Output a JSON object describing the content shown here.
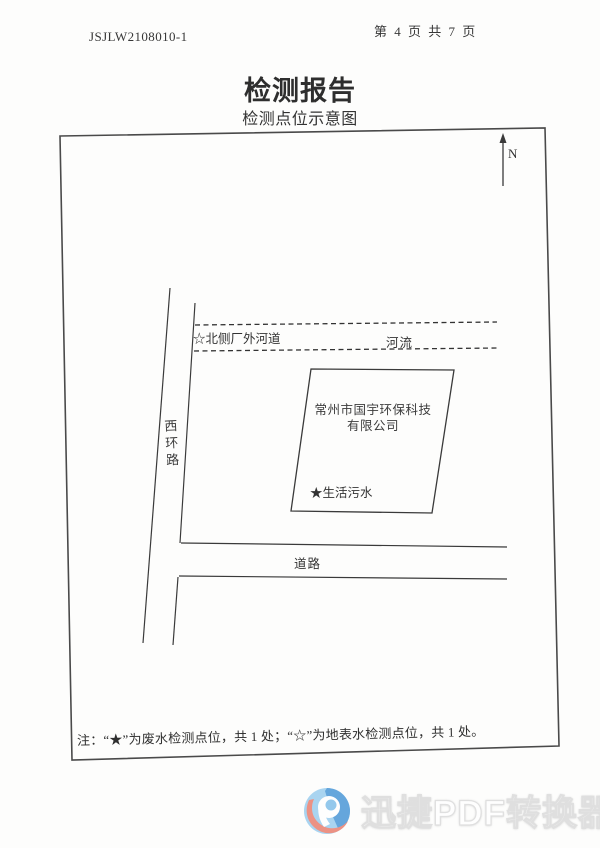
{
  "header": {
    "report_no": "JSJLW2108010-1",
    "page_indicator": "第 4 页 共 7 页"
  },
  "titles": {
    "title": "检测报告",
    "subtitle": "检测点位示意图"
  },
  "diagram": {
    "north_label": "N",
    "surface_water_point_label": "☆北侧厂外河道",
    "river_label": "河流",
    "west_ring_road_label": "西环路",
    "company_name_line1": "常州市国宇环保科技",
    "company_name_line2": "有限公司",
    "wastewater_point_label": "★生活污水",
    "road_label": "道路",
    "note": "注：“★”为废水检测点位，共 1 处；“☆”为地表水检测点位，共 1 处。"
  },
  "watermark": {
    "text": "迅捷PDF转换器",
    "logo_icon": "xunjie-pdf-converter-logo",
    "logo_colors": {
      "light_blue": "#a5d2f0",
      "dark_blue": "#559cd8",
      "white": "#ffffff",
      "salmon": "#ec8d7e"
    }
  },
  "colors": {
    "ink": "#3c3c3c",
    "paper": "#fdfdfc"
  }
}
